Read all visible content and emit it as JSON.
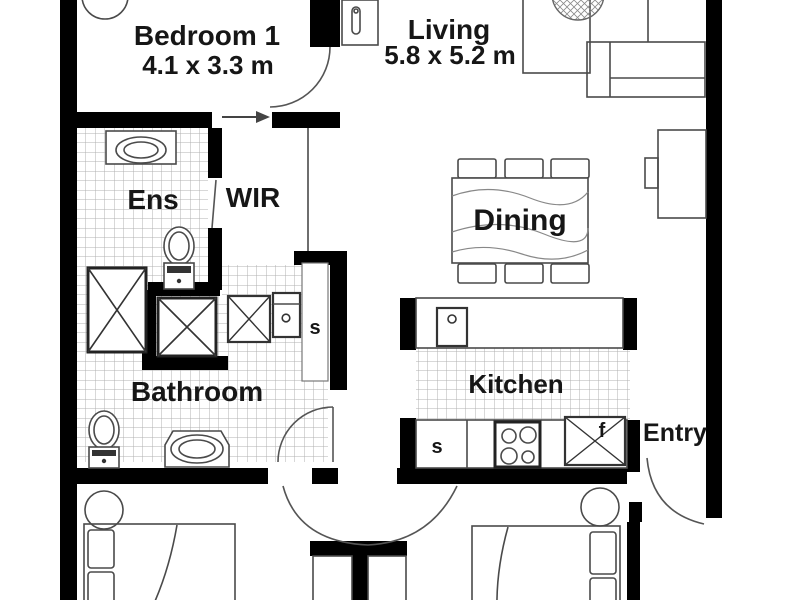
{
  "title": "Apartment floor plan",
  "rooms": {
    "bedroom1": {
      "name": "Bedroom 1",
      "dims": "4.1 x 3.3 m"
    },
    "living": {
      "name": "Living",
      "dims": "5.8 x 5.2 m"
    },
    "ensuite": {
      "name": "Ens"
    },
    "wir": {
      "name": "WIR"
    },
    "dining": {
      "name": "Dining"
    },
    "kitchen": {
      "name": "Kitchen"
    },
    "bathroom": {
      "name": "Bathroom"
    },
    "entry": {
      "name": "Entry"
    }
  },
  "labels": {
    "linen_cupboard": "s",
    "kitchen_sink": "s",
    "fridge": "f"
  },
  "colors": {
    "wall": "#000000",
    "outline": "#4a4a4a",
    "tile": "#b0b0b0",
    "text": "#161616",
    "background": "#ffffff"
  }
}
